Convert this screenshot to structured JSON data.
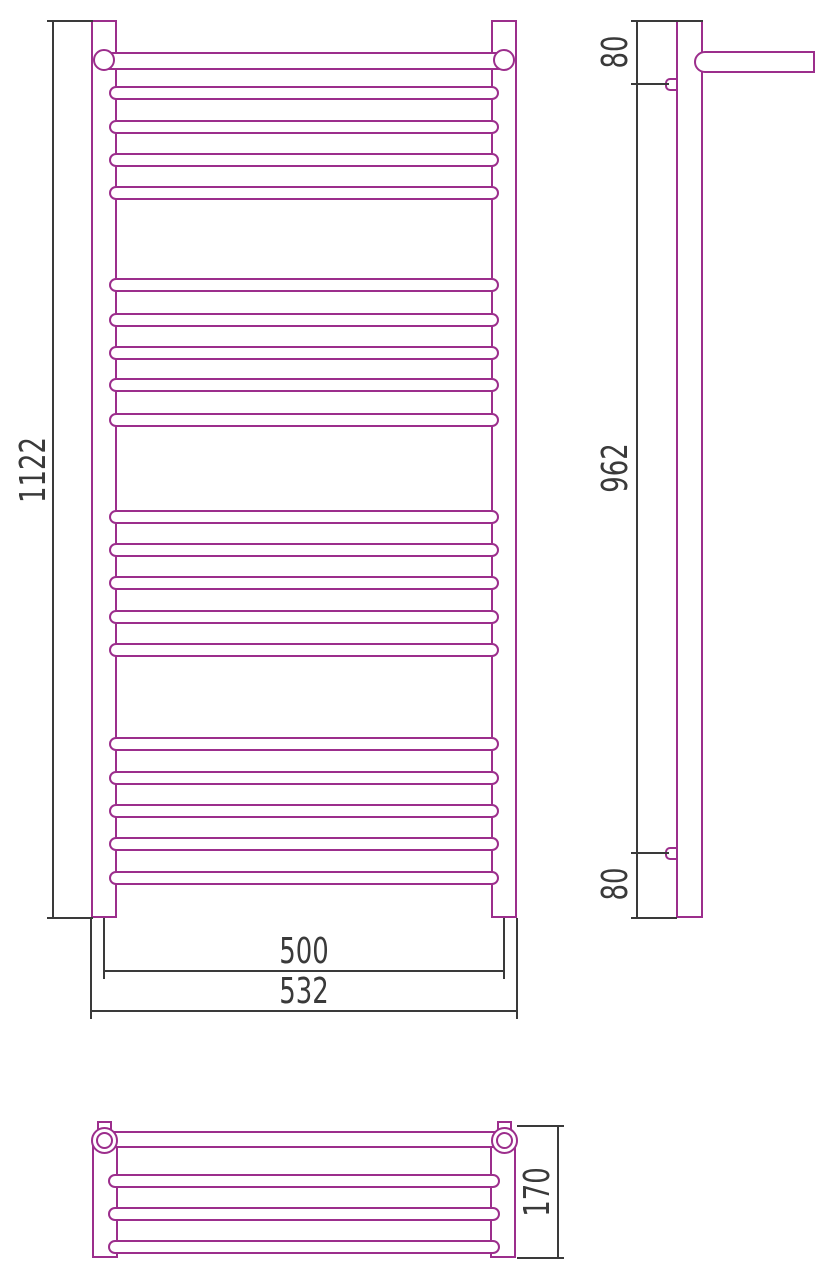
{
  "drawing": {
    "type": "technical-drawing",
    "subject": "ladder towel rail, three orthographic views with dimensions",
    "colors": {
      "outline": "#9c2e8c",
      "dimension": "#3a3a3a",
      "background": "#ffffff"
    },
    "front_view": {
      "height_label": "1122",
      "centers_width_label": "500",
      "overall_width_label": "532",
      "rung_groups": [
        5,
        5,
        5,
        5
      ]
    },
    "side_view": {
      "top_offset_label": "80",
      "mount_span_label": "962",
      "bottom_offset_label": "80"
    },
    "top_view": {
      "depth_label": "170",
      "tube_count": 4
    }
  }
}
